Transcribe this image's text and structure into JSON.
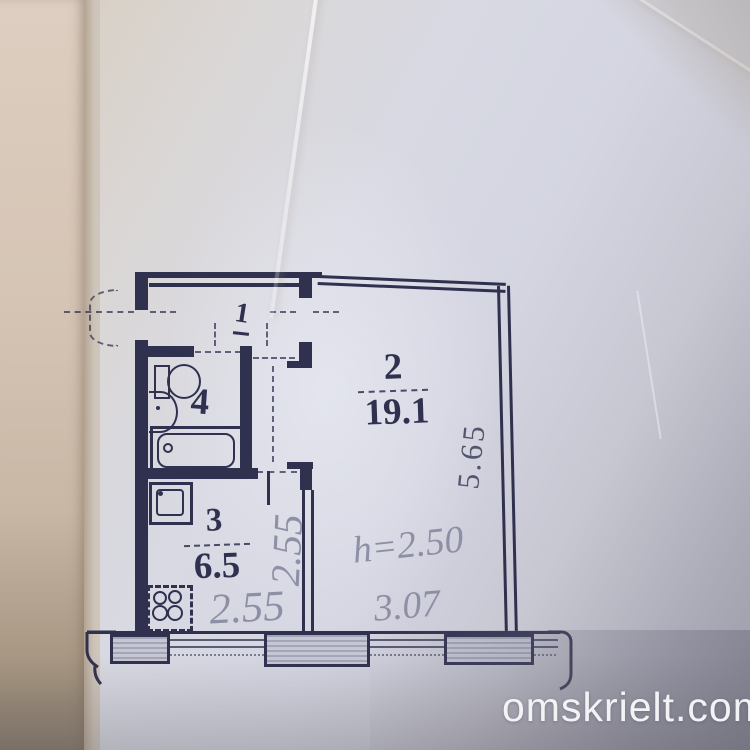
{
  "watermark": {
    "text": "omskrielt.com"
  },
  "floor_plan": {
    "type": "apartment-floor-plan",
    "rooms": [
      {
        "id": "hallway",
        "label": "1"
      },
      {
        "id": "living-room",
        "label": "2",
        "area": "19.1"
      },
      {
        "id": "kitchen",
        "label": "3",
        "area": "6.5"
      },
      {
        "id": "bathroom",
        "label": "4"
      }
    ],
    "dimensions": {
      "living_room_side": "5.65",
      "kitchen_depth_vertical": "2.55",
      "kitchen_width_horizontal": "2.55",
      "ceiling_height": "h=2.50",
      "living_room_width": "3.07"
    },
    "colors": {
      "ink": "#30314f",
      "pencil": "#8a8da2"
    }
  }
}
